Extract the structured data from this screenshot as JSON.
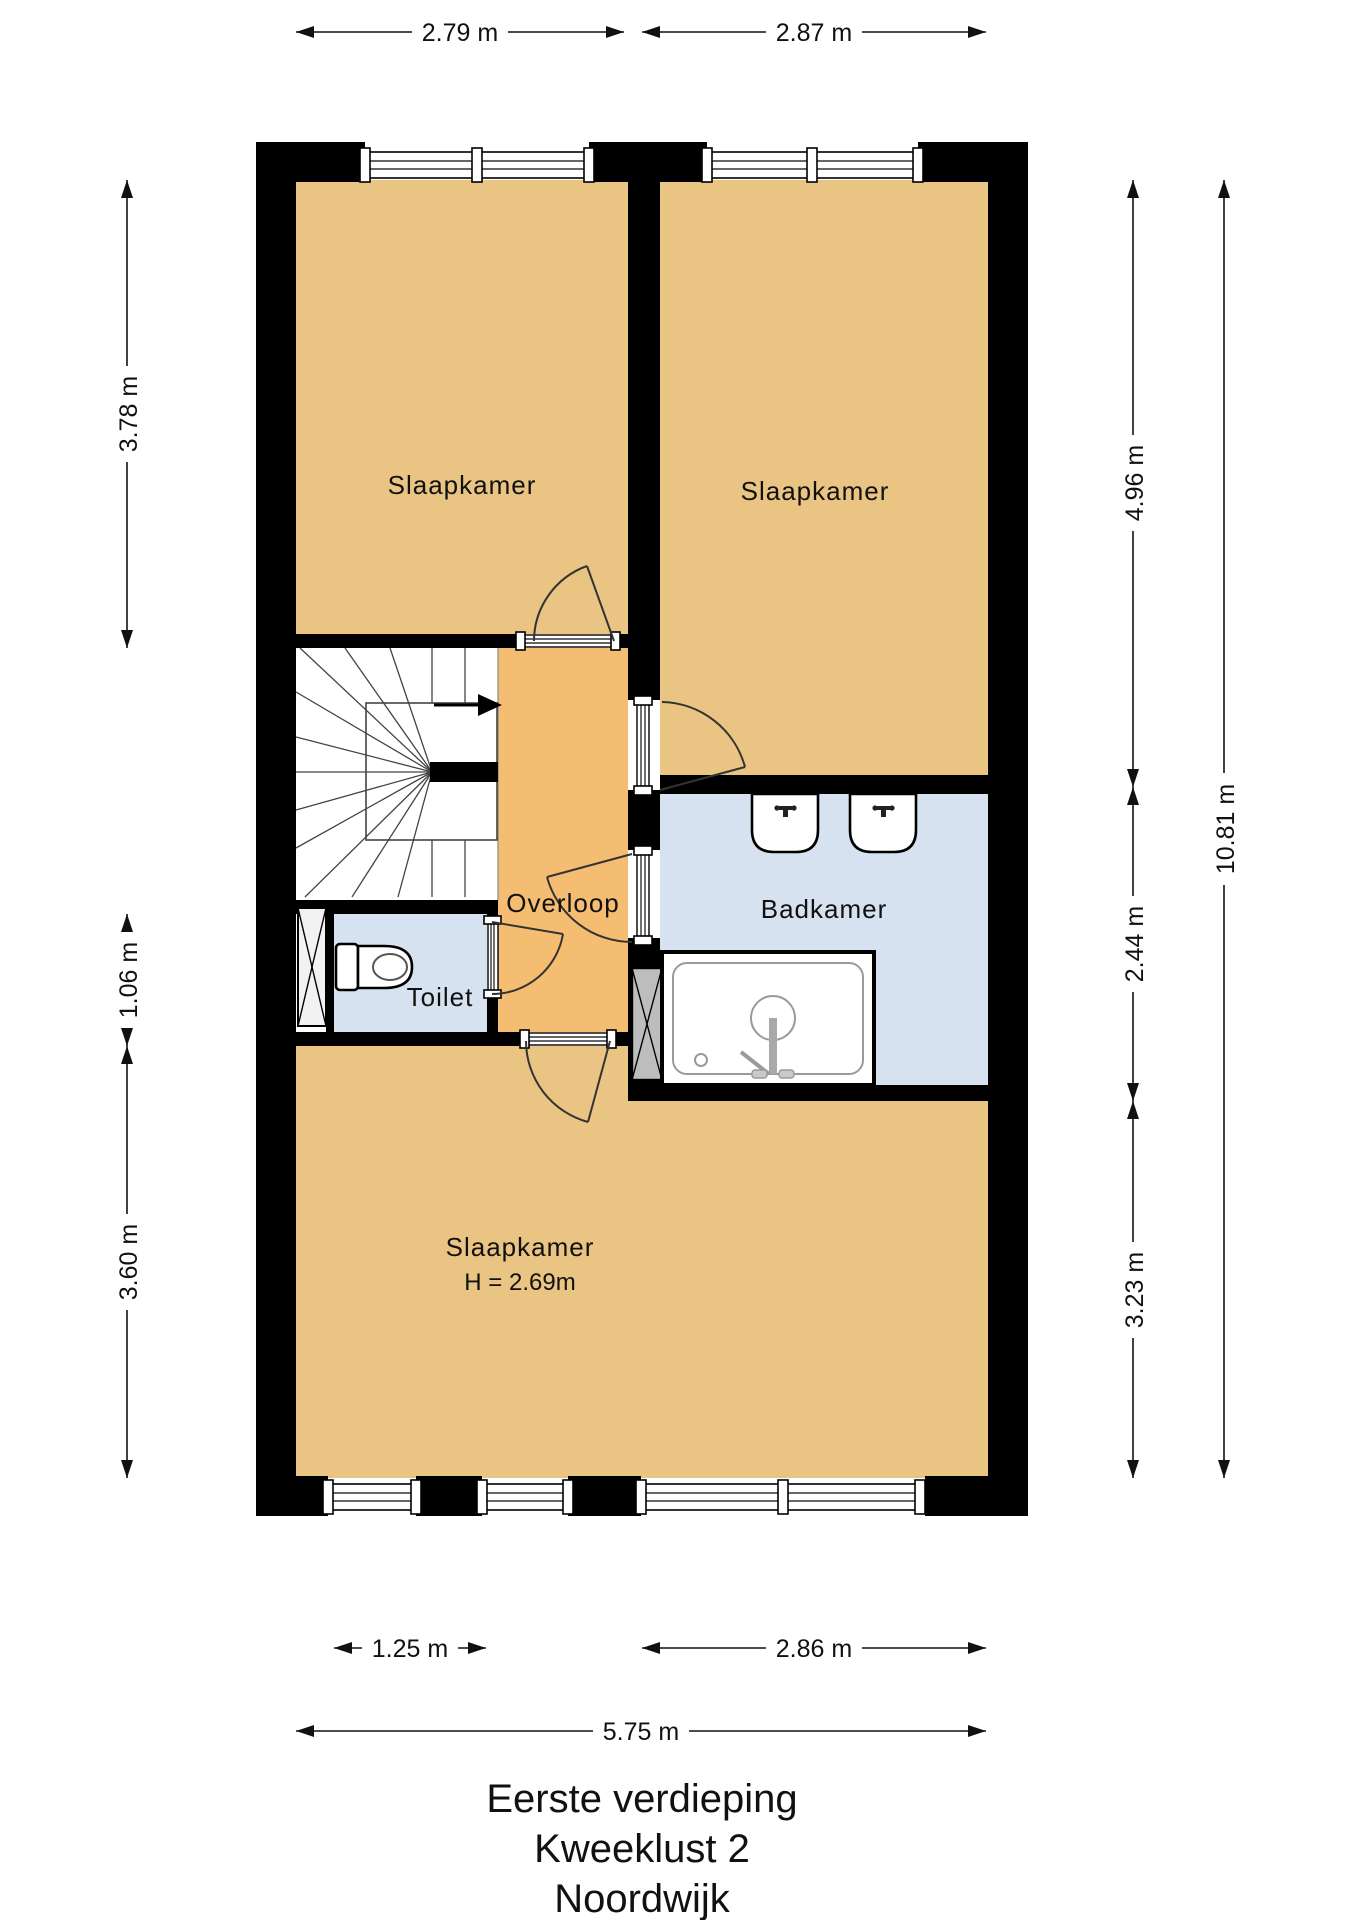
{
  "title": {
    "lines": [
      "Eerste verdieping",
      "Kweeklust 2",
      "Noordwijk"
    ]
  },
  "rooms": {
    "bedroom_top_left": "Slaapkamer",
    "bedroom_top_right": "Slaapkamer",
    "landing": "Overloop",
    "bathroom": "Badkamer",
    "toilet": "Toilet",
    "bedroom_bottom": "Slaapkamer",
    "bedroom_bottom_height": "H = 2.69m"
  },
  "dimensions": {
    "top": [
      "2.79 m",
      "2.87 m"
    ],
    "left": [
      "3.78 m",
      "1.06 m",
      "3.60 m"
    ],
    "right_inner": [
      "4.96 m",
      "2.44 m",
      "3.23 m"
    ],
    "right_total": "10.81 m",
    "bottom": [
      "1.25 m",
      "2.86 m"
    ],
    "bottom_total": "5.75 m"
  },
  "colors": {
    "room": "#eac483",
    "landing": "#f5bd72",
    "wet_room": "#d6e2f0",
    "wall": "#000000",
    "shaft_gray": "#bdbdbd"
  }
}
